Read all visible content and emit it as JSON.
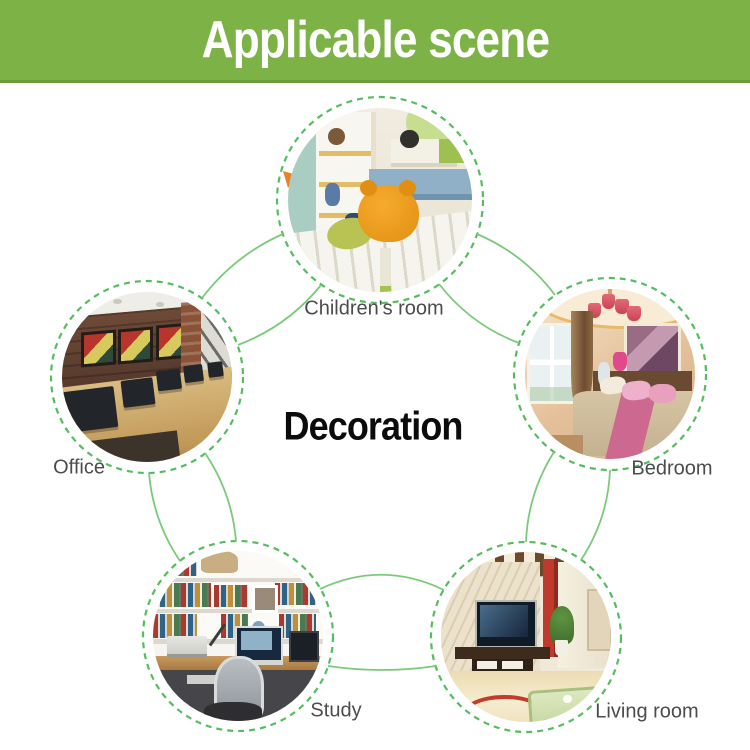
{
  "banner": {
    "title": "Applicable scene",
    "bg_color": "#7cb246",
    "text_color": "#ffffff"
  },
  "diagram": {
    "center_label": "Decoration",
    "label_color": "#4c4c4e",
    "ring_color": "#55bd5f",
    "arc_color": "#7bca7b",
    "arrow_color": "#e8822a",
    "nodes": [
      {
        "id": "childrens-room",
        "label": "Children's room"
      },
      {
        "id": "office",
        "label": "Office"
      },
      {
        "id": "bedroom",
        "label": "Bedroom"
      },
      {
        "id": "study",
        "label": "Study"
      },
      {
        "id": "living-room",
        "label": "Living room"
      }
    ]
  }
}
